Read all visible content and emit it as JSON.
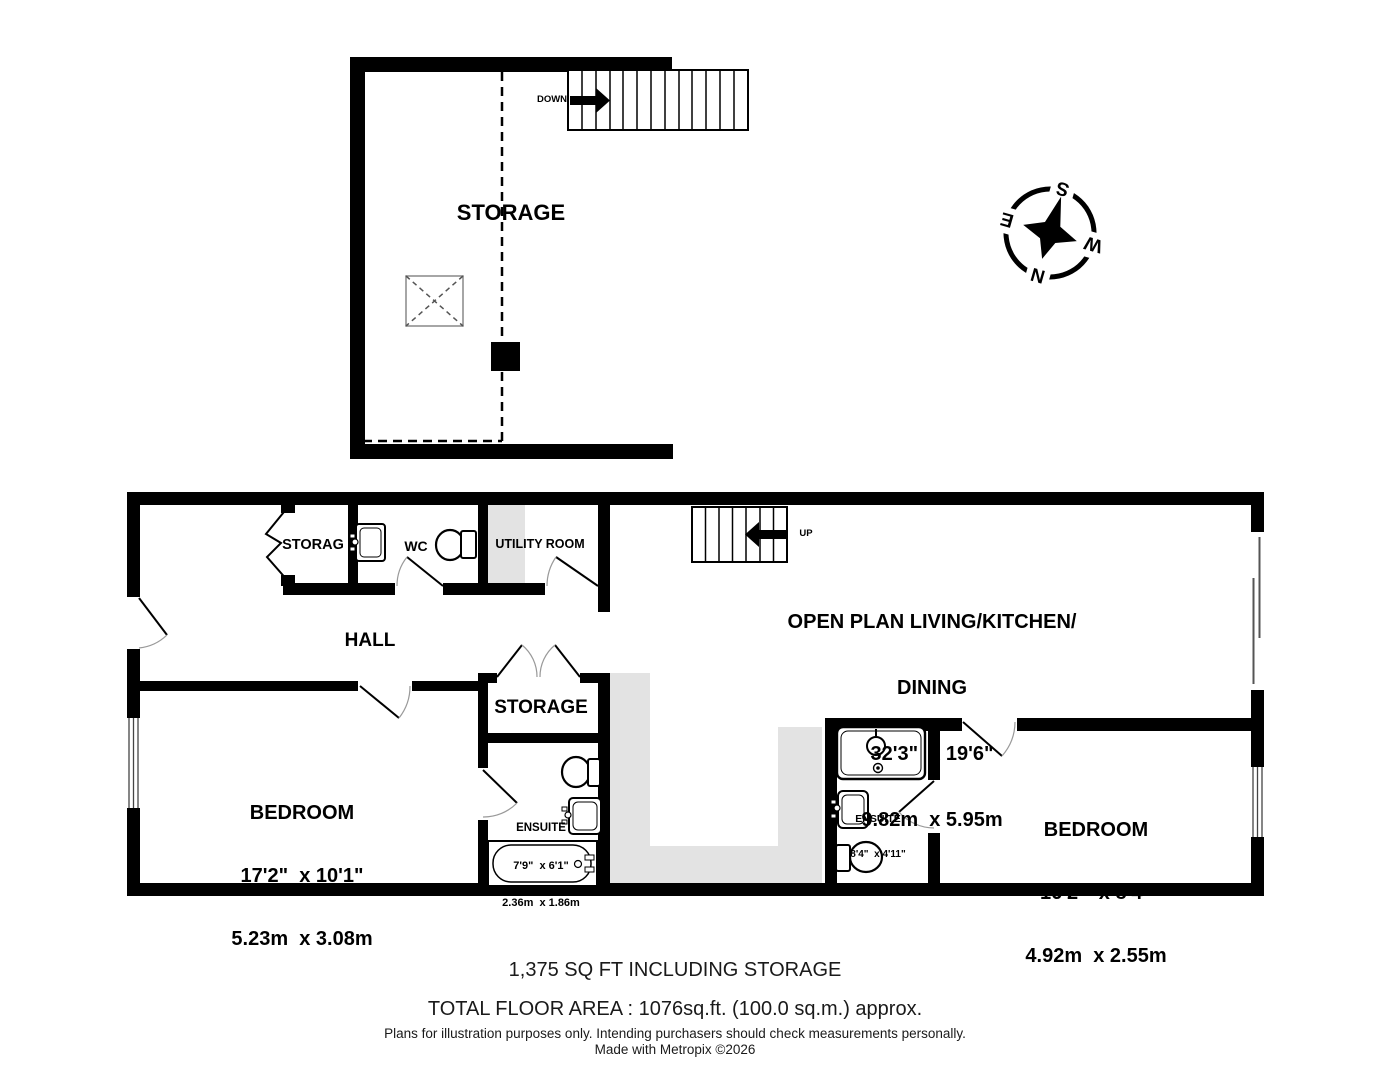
{
  "upper_floor": {
    "storage": "STORAGE",
    "stairs_direction": "DOWN"
  },
  "main_floor": {
    "closet": "STORAG",
    "wc": "WC",
    "utility_room": "UTILITY ROOM",
    "hall": "HALL",
    "stairs_direction": "UP",
    "open_plan": {
      "title_line1": "OPEN PLAN LIVING/KITCHEN/",
      "title_line2": "DINING",
      "size_imperial": "32'3\"  x 19'6\"",
      "size_metric": "9.82m  x 5.95m"
    },
    "storage": "STORAGE",
    "bedroom_left": {
      "title": "BEDROOM",
      "size_imperial": "17'2\"  x 10'1\"",
      "size_metric": "5.23m  x 3.08m"
    },
    "ensuite_left": {
      "title": "ENSUITE",
      "size_imperial": "7'9\"  x 6'1\"",
      "size_metric": "2.36m  x 1.86m"
    },
    "ensuite_right": {
      "title": "ENSUITE",
      "size_imperial": "8'4\"  x 4'11\"",
      "size_metric": "2.55m  x 1.50m"
    },
    "bedroom_right": {
      "title": "BEDROOM",
      "size_imperial": "16'2\"  x 8'4\"",
      "size_metric": "4.92m  x 2.55m"
    }
  },
  "compass": {
    "north": "N",
    "south": "S",
    "east": "E",
    "west": "W"
  },
  "footer": {
    "area_including_storage": "1,375 SQ FT INCLUDING STORAGE",
    "total_area": "TOTAL FLOOR AREA : 1076sq.ft. (100.0 sq.m.) approx.",
    "disclaimer": "Plans for illustration purposes only. Intending purchasers should check measurements personally.",
    "credit": "Made with Metropix ©2026"
  },
  "colors": {
    "wall": "#000000",
    "floor_highlight": "#e3e3e3"
  }
}
